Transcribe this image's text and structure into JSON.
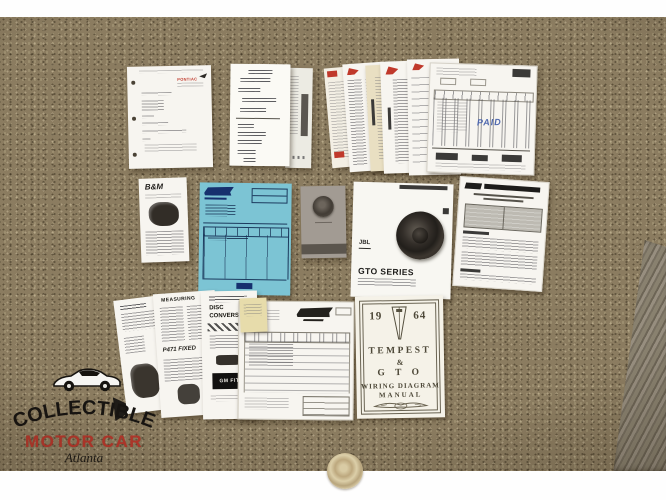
{
  "photo": {
    "surface": "carpet",
    "carpet_color": "#8b7c60",
    "band_color": "#fefefe"
  },
  "watermark": {
    "title": "COLLECTIBLE",
    "subtitle": "MOTOR CAR",
    "script": "Atlanta",
    "subtitle_color": "#b5372b",
    "title_color": "#171411"
  },
  "documents": {
    "typed_letter": {
      "brand": "PONTIAC",
      "brand_color": "#c0392b"
    },
    "invoice_stack": {
      "paid_stamp": "PAID",
      "paid_color": "#4f68ae",
      "logo_color": "#c0392b"
    },
    "bm_leaflet": {
      "brand": "B&M"
    },
    "blue_invoice": {
      "paper_color": "#7cc4d4"
    },
    "jbl_manual": {
      "brand": "JBL",
      "title": "GTO SERIES"
    },
    "measuring_sheet": {
      "heading": "MEASURING",
      "part": "P471 FIXED"
    },
    "conversion_sheet": {
      "line1": "DISC",
      "line2": "CONVERSION",
      "badge": "GM FIT"
    },
    "wiring_manual": {
      "year_left": "19",
      "year_right": "64",
      "model1": "TEMPEST",
      "ampersand": "&",
      "model2": "G T O",
      "title_line1": "WIRING  DIAGRAM",
      "title_line2": "MANUAL"
    }
  }
}
